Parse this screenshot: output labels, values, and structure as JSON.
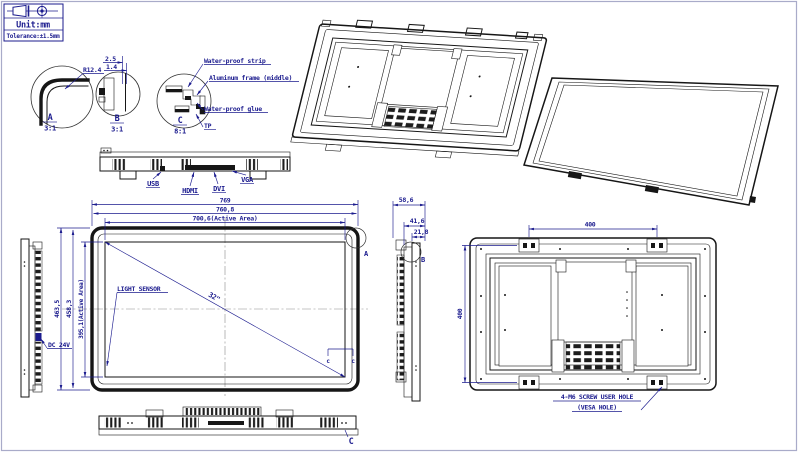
{
  "drawing": {
    "title_block": {
      "unit_label": "Unit:mm",
      "tolerance_label": "Tolerance:±1.5mm"
    },
    "details": {
      "a": {
        "marker": "A",
        "scale": "3:1",
        "radius_dim": "R12.4"
      },
      "b": {
        "marker": "B",
        "scale": "3:1",
        "dim_top": "2.5",
        "dim_bottom": "1.4"
      },
      "c": {
        "marker": "C",
        "scale": "8:1",
        "callouts": [
          "Water-proof strip",
          "Aluminum frame (middle)",
          "Water-proof glue",
          "TP"
        ]
      }
    },
    "bottom_edge_view": {
      "connector_labels": [
        "USB",
        "HDMI",
        "DVI",
        "VGA"
      ]
    },
    "front_view": {
      "overall_width": "769",
      "bezel_width": "760,8",
      "active_width": "700,6(Active Area)",
      "overall_height": "463,5",
      "bezel_height": "458,3",
      "active_height": "395,1(Active Area)",
      "light_sensor_label": "LIGHT SENSOR",
      "diagonal_size": "32\"",
      "corner_detail_marker": "A",
      "section_marks": [
        "c",
        "c"
      ]
    },
    "left_side_view": {
      "power_label": "DC 24V"
    },
    "right_side_view": {
      "depth_total": "58,6",
      "depth_mid": "41,6",
      "depth_front": "21,8",
      "detail_marker": "B"
    },
    "bottom_view": {
      "detail_marker": "C"
    },
    "rear_view": {
      "vesa_width": "400",
      "vesa_height": "400",
      "vesa_note_line1": "4-M6 SCREW USER HOLE",
      "vesa_note_line2": "(VESA HOLE)"
    }
  },
  "colors": {
    "line": "#161616",
    "dimension": "#1b1b8e",
    "border": "#a9abc9",
    "centerline": "#8a8a8a"
  }
}
